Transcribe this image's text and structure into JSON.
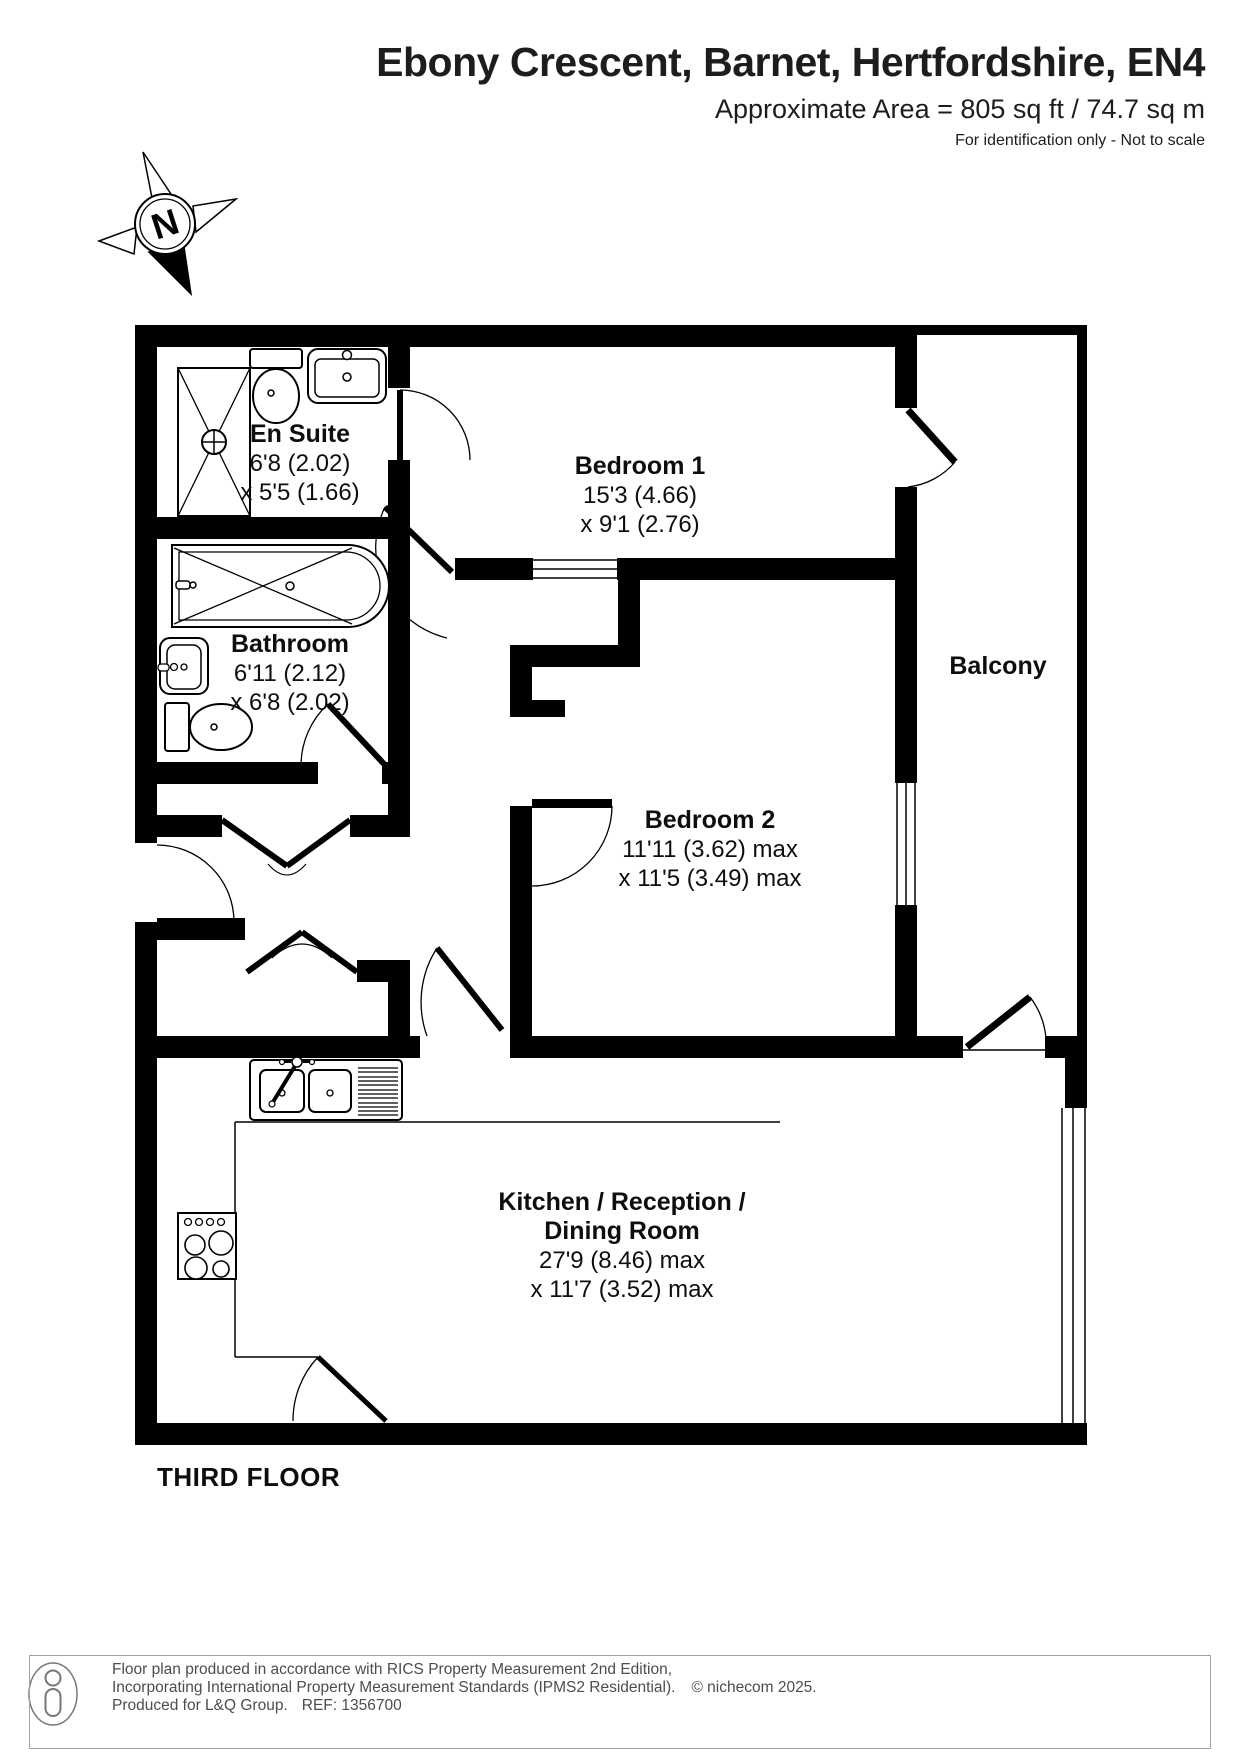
{
  "header": {
    "title": "Ebony Crescent, Barnet, Hertfordshire, EN4",
    "area": "Approximate Area = 805 sq ft / 74.7 sq m",
    "disclaimer": "For identification only - Not to scale"
  },
  "compass": {
    "north_label": "N"
  },
  "floor": {
    "label": "THIRD FLOOR"
  },
  "rooms": {
    "en_suite": {
      "name": "En Suite",
      "dim1": "6'8 (2.02)",
      "dim2": "x 5'5 (1.66)"
    },
    "bedroom_1": {
      "name": "Bedroom 1",
      "dim1": "15'3 (4.66)",
      "dim2": "x 9'1 (2.76)"
    },
    "bathroom": {
      "name": "Bathroom",
      "dim1": "6'11 (2.12)",
      "dim2": "x 6'8 (2.02)"
    },
    "bedroom_2": {
      "name": "Bedroom 2",
      "dim1": "11'11 (3.62) max",
      "dim2": "x 11'5 (3.49) max"
    },
    "balcony": {
      "name": "Balcony"
    },
    "kitchen_reception_dining": {
      "name_line1": "Kitchen / Reception /",
      "name_line2": "Dining Room",
      "dim1": "27'9 (8.46) max",
      "dim2": "x 11'7 (3.52) max"
    }
  },
  "footer": {
    "line1": "Floor plan produced in accordance with RICS Property Measurement 2nd Edition,",
    "line2": "Incorporating International Property Measurement Standards (IPMS2 Residential).",
    "copyright": "© nichecom 2025.",
    "line3": "Produced for L&Q Group.",
    "ref": "REF: 1356700"
  },
  "colors": {
    "wall": "#000000",
    "text": "#1a1a1a",
    "footer_text": "#4d4d4d"
  }
}
